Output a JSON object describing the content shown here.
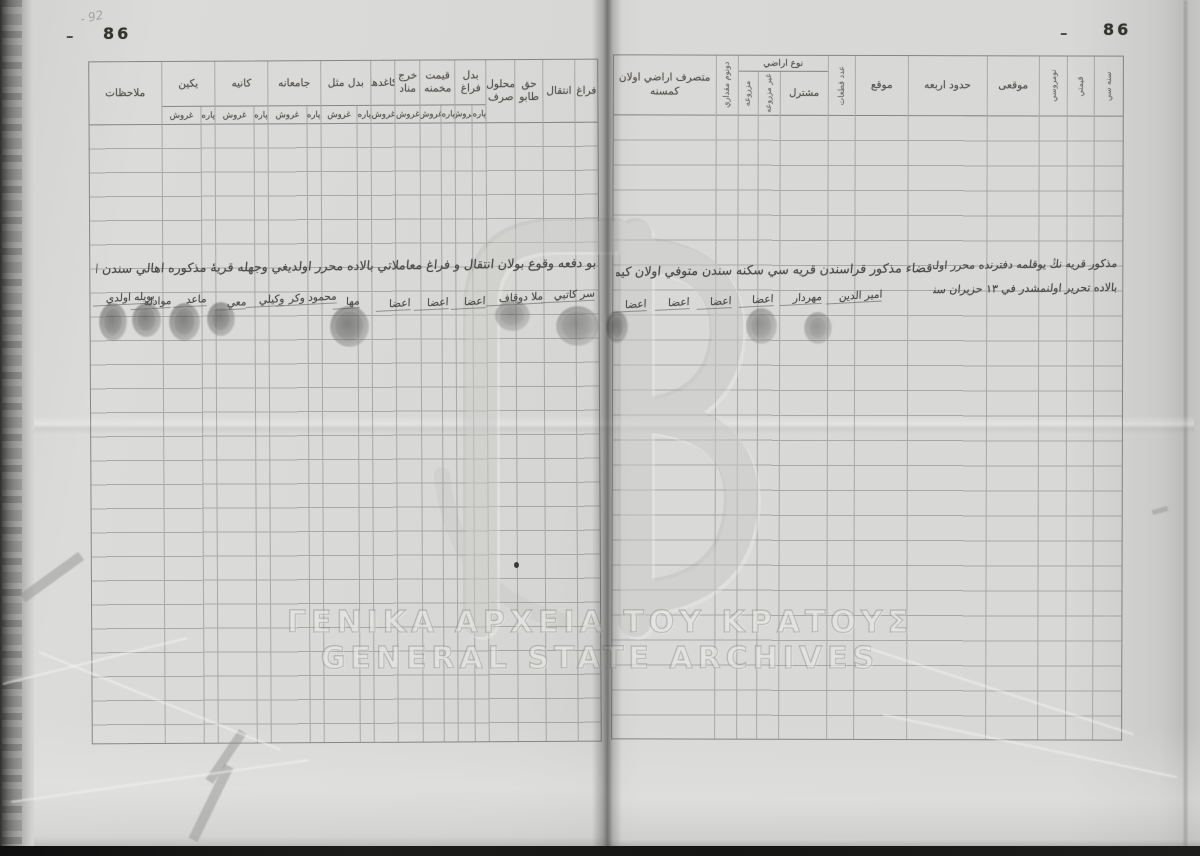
{
  "page": {
    "left_number": "86",
    "right_number": "86",
    "left_dash": "–",
    "right_dash": "–",
    "pencil_note": "- 92"
  },
  "units": {
    "kurus": "غروش",
    "para": "پاره"
  },
  "labels": {
    "member": "اعضا"
  },
  "left_table": {
    "columns": [
      {
        "label": "ملاحظات"
      },
      {
        "label": "يكين"
      },
      {
        "label": "كانيه"
      },
      {
        "label": "جامعانه"
      },
      {
        "label": "بدل مثل"
      },
      {
        "label": "كاغدها"
      },
      {
        "label": "خرج مناد"
      },
      {
        "label": "قيمت مخمنه"
      },
      {
        "label": "بدل فراغ"
      },
      {
        "label": "محلول صرف"
      },
      {
        "label": "حق طابو"
      },
      {
        "label": "انتقال"
      },
      {
        "label": "فراغ"
      }
    ]
  },
  "right_table": {
    "columns": [
      {
        "label": "متصرف اراضي اولان كمسنه"
      },
      {
        "label": "دونوم مقداري"
      },
      {
        "label": "نوع اراضي",
        "subs": [
          "مزروعه",
          "غير مزروعه",
          "مشترل"
        ]
      },
      {
        "label": "عدد قطعات"
      },
      {
        "label": "موقع"
      },
      {
        "label": "حدود اربعه"
      },
      {
        "label": "موقعى"
      },
      {
        "label": "نومروسي"
      },
      {
        "label": "قيمتي"
      },
      {
        "label": "سنه سي"
      }
    ]
  },
  "handwriting": {
    "left_line": "بو دفعه وقوع بولان انتقال و فراغ معاملاتي بالاده محرر اولديغي وجهله قريهٔ مذكوره اهالي سندن اولوب خصوص بكاها افندي بالاده محرر اولنمشدر",
    "right_line": "قضاء مذكور قراسندن قريه سي سكنه سندن متوفي اولان كيمسه نڭ اوزرنده بولنان اراضي يوقلمه سنده قيد اولنمشدر",
    "right_note_1": "مذكور قريه نڭ يوقلمه دفترنده محرر اولديغي وجهله",
    "right_note_2": "بالاده تحرير اولنمشدر في ١٣ حزيران سنه ٩٦",
    "left_signatures": [
      {
        "text": "بويله اولدي"
      },
      {
        "text": "موادله"
      },
      {
        "text": "ماعد"
      },
      {
        "text": "معي"
      },
      {
        "text": "وكيلي"
      },
      {
        "text": "محمود وكر"
      },
      {
        "text": "مها"
      },
      {
        "text": "ملا دوقاف"
      },
      {
        "text": "سر كاتبي"
      }
    ],
    "right_signatures": [
      {
        "text": "مهردار"
      },
      {
        "text": "امير الدين"
      }
    ]
  },
  "watermark": {
    "line1": "ΓΕΝΙΚΑ ΑΡΧΕΙΑ ΤΟΥ ΚΡΑΤΟΥΣ",
    "line2": "GENERAL STATE ARCHIVES"
  }
}
